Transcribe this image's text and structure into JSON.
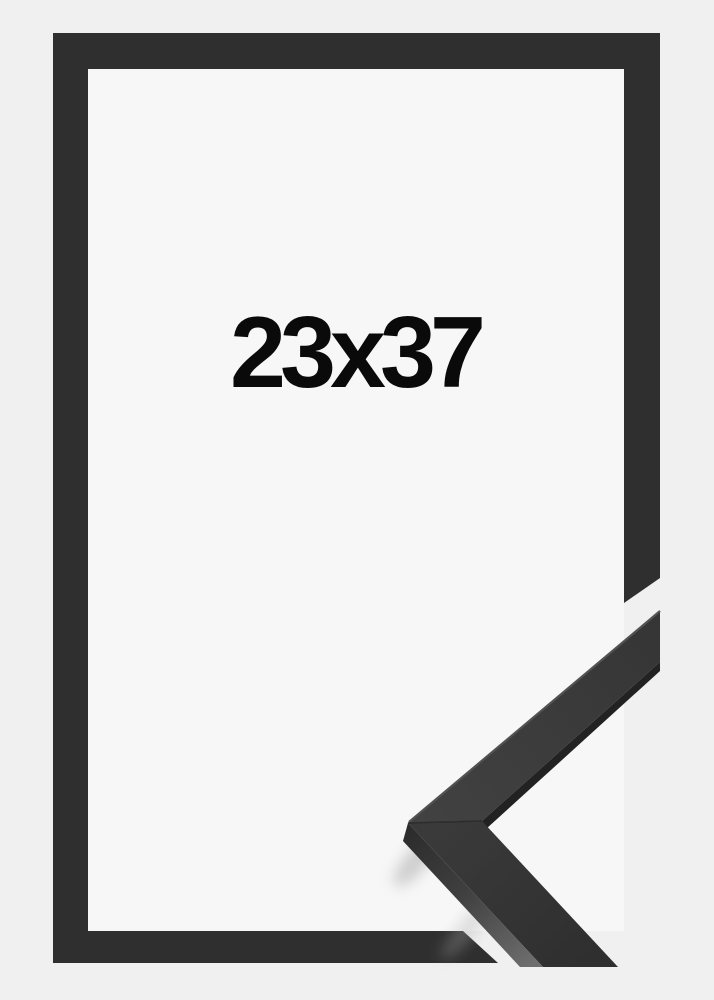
{
  "product": {
    "size_label": "23x37"
  },
  "image": {
    "description": "black picture frame product photo with corner profile close-up",
    "frame_style": "flat black moulding"
  },
  "colors": {
    "background": "#f0f0f0",
    "interior": "#f7f7f7",
    "frame": "#2f2f2f",
    "text": "#0a0a0a",
    "arm_upper_light": "#424242",
    "arm_upper_dark": "#353535",
    "arm_lower_light": "#3a3a3a",
    "arm_lower_dark": "#2f2f2f",
    "side_face_top": "#2c2c2c",
    "side_face_bottom": "#6e6e6e",
    "inner_lip": "#222222",
    "edge_highlight": "#525252",
    "miter_seam": "#262626",
    "shadow": "#aaaaaa"
  }
}
